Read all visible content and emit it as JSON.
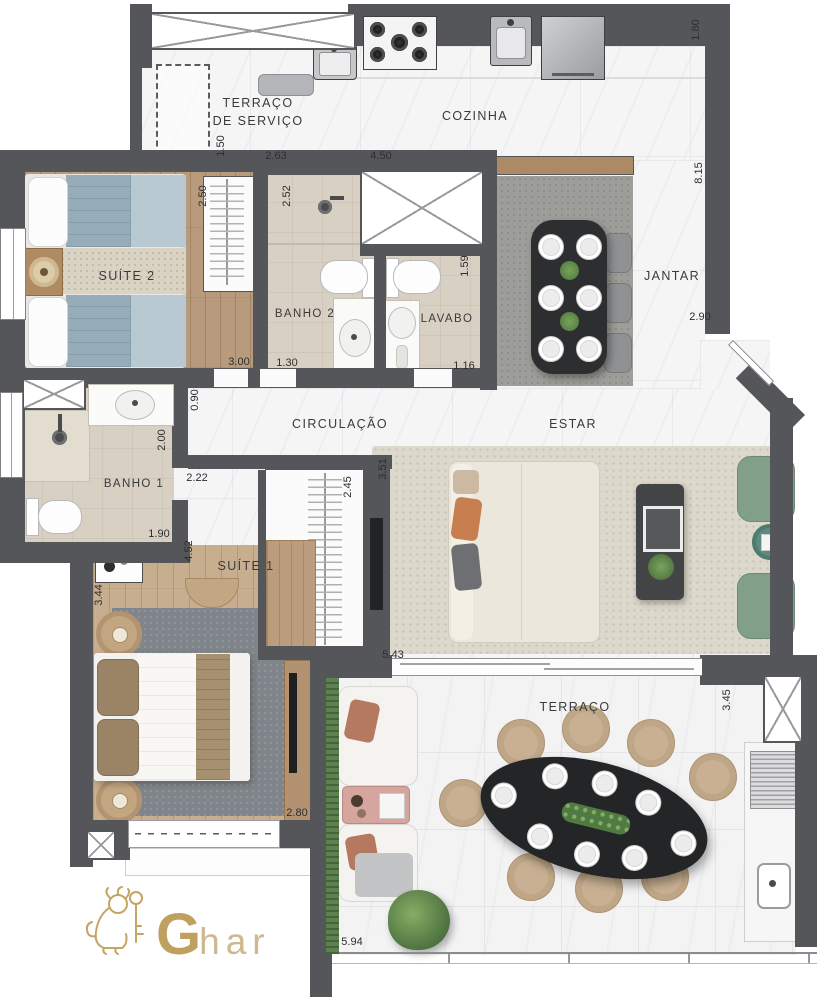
{
  "plan": {
    "rooms": {
      "terraco_servico": {
        "line1": "TERRAÇO",
        "line2": "DE SERVIÇO"
      },
      "cozinha": {
        "label": "COZINHA"
      },
      "suite2": {
        "label": "SUÍTE 2"
      },
      "banho2": {
        "label": "BANHO 2"
      },
      "lavabo": {
        "label": "LAVABO"
      },
      "jantar": {
        "label": "JANTAR"
      },
      "circulacao": {
        "label": "CIRCULAÇÃO"
      },
      "banho1": {
        "label": "BANHO 1"
      },
      "estar": {
        "label": "ESTAR"
      },
      "suite1": {
        "label": "SUÍTE 1"
      },
      "terraco": {
        "label": "TERRAÇO"
      }
    },
    "dimensions": {
      "d150": "1.50",
      "d263": "2.63",
      "d450": "4.50",
      "d180": "1.80",
      "d815": "8.15",
      "d250": "2.50",
      "d252": "2.52",
      "d159": "1.59",
      "d300": "3.00",
      "d130": "1.30",
      "d116": "1.16",
      "d290": "2.90",
      "d090": "0.90",
      "d200": "2.00",
      "d222": "2.22",
      "d245": "2.45",
      "d351": "3.51",
      "d190": "1.90",
      "d452": "4.52",
      "d344": "3.44",
      "d543": "5.43",
      "d280": "2.80",
      "d345": "3.45",
      "d594": "5.94"
    },
    "logo": {
      "g": "G",
      "har": "har"
    },
    "colors": {
      "wall": "#55565a",
      "gold": "#bfa05e",
      "wood": "#c7ae8f",
      "green_chair": "#82a089"
    }
  }
}
